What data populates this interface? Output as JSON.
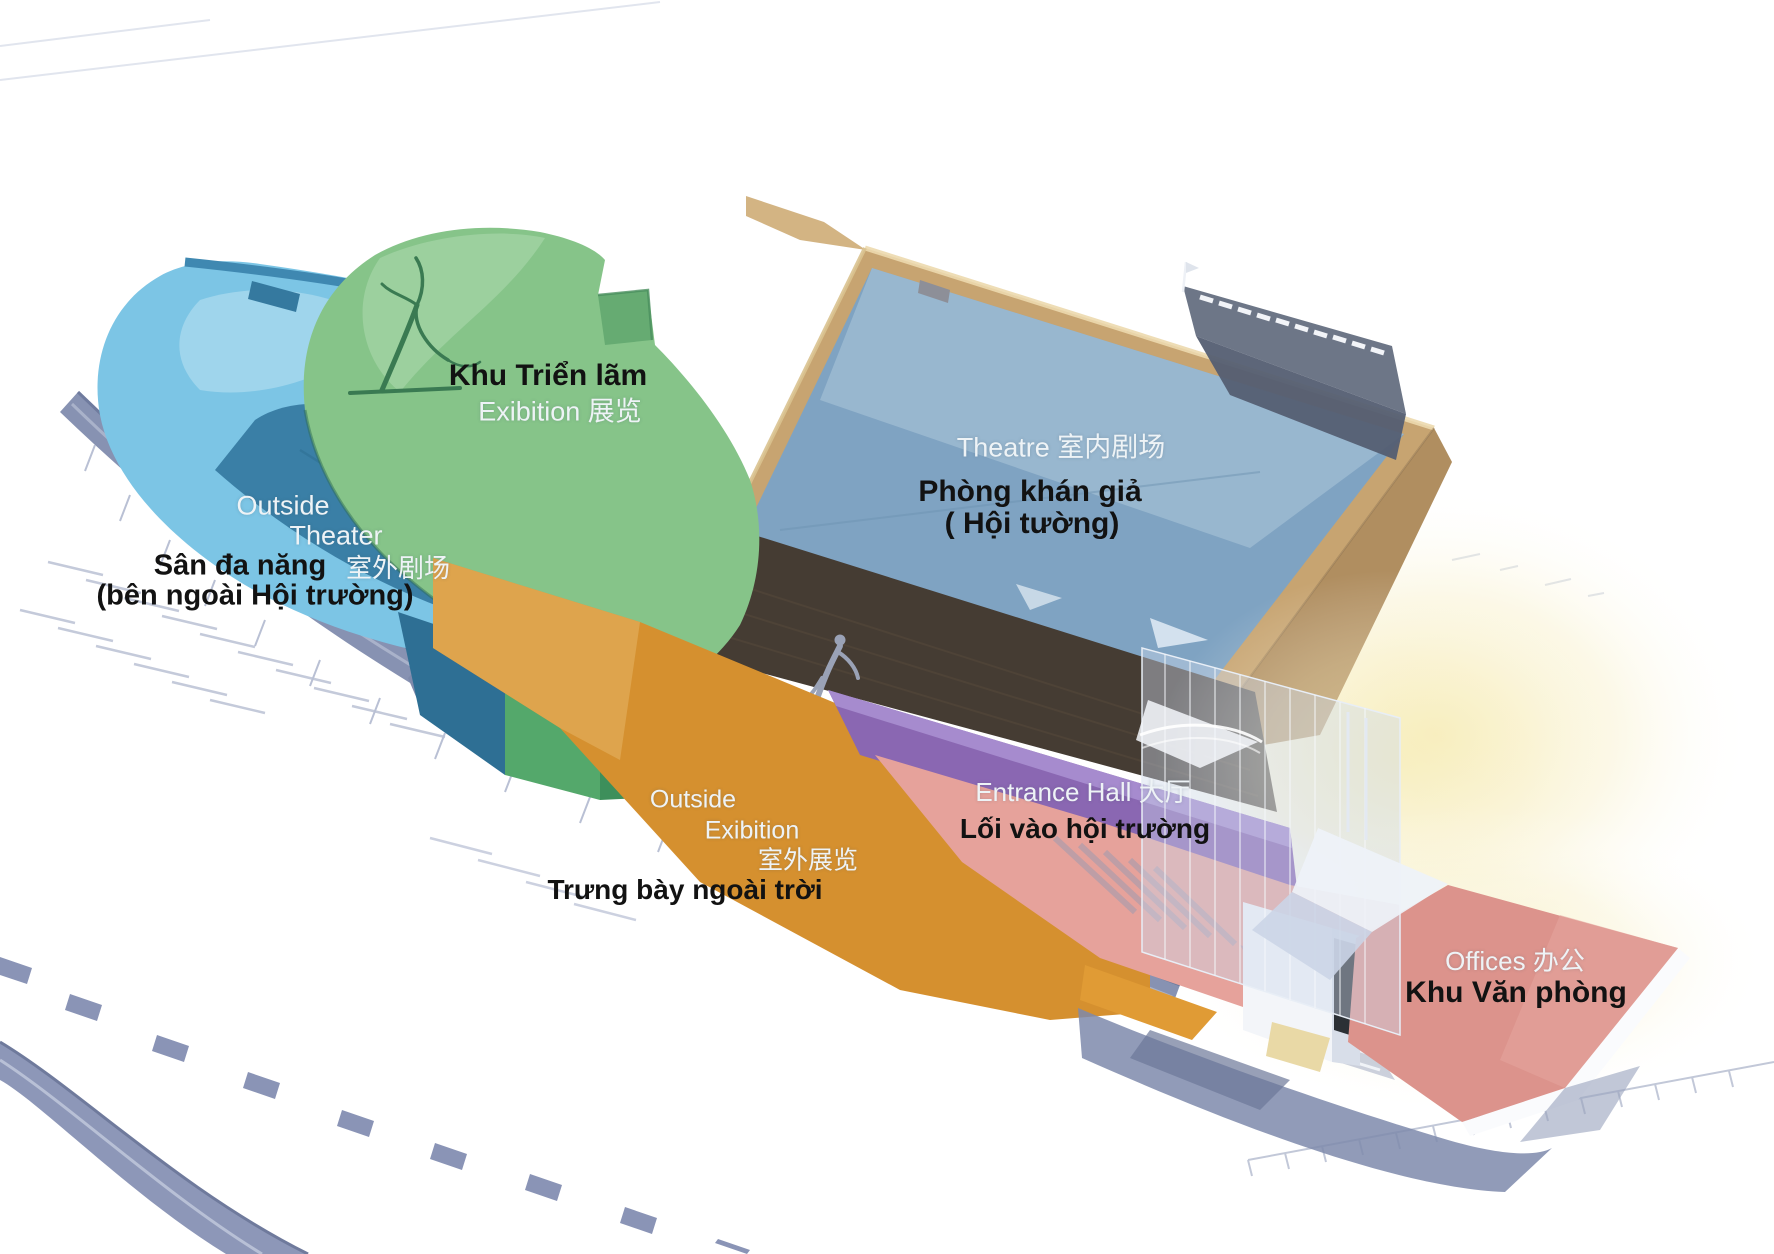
{
  "title": "Theatre complex functional zoning axonometric diagram",
  "zones": {
    "exhibition": {
      "name": "Exhibition Area",
      "vi": "Khu Triển lãm",
      "en": "Exibition 展览",
      "color": "#86c489"
    },
    "outside_theater": {
      "name": "Outside Theater",
      "en_line1": "Outside",
      "en_line2": "Theater",
      "zh": "室外剧场",
      "vi_line1": "Sân đa năng",
      "vi_line2": "(bên ngoài Hội trường)",
      "color": "#7cc5e5",
      "slope_color": "#3a7fa6"
    },
    "theatre": {
      "name": "Theatre",
      "en": "Theatre 室内剧场",
      "vi_line1": "Phòng khán giả",
      "vi_line2": "( Hội tường)",
      "color": "#7fa3c2"
    },
    "outside_exhibition": {
      "name": "Outside Exhibition",
      "en_line1": "Outside",
      "en_line2": "Exibition",
      "zh": "室外展览",
      "vi": "Trưng bày ngoài trời",
      "color": "#d5902f"
    },
    "entrance_hall": {
      "name": "Entrance Hall",
      "en": "Entrance Hall 大厅",
      "vi": "Lối vào hội trường",
      "color": "#8a67b2"
    },
    "offices": {
      "name": "Offices",
      "en": "Offices 办公",
      "vi": "Khu Văn phòng",
      "color": "#dc938c"
    }
  },
  "palette": {
    "background": "#ffffff",
    "tan": "#c7a471",
    "tan_dark": "#b08e60",
    "dark_wall": "#453c33",
    "pink_band": "#e6a29b",
    "gray_ramp": "#8792b2",
    "road_block": "#8a94b6",
    "shadow": "#7e89ab",
    "glow": "#f7edb9",
    "fly_tower": "#6d7687",
    "glass": "#cdd9eb"
  }
}
